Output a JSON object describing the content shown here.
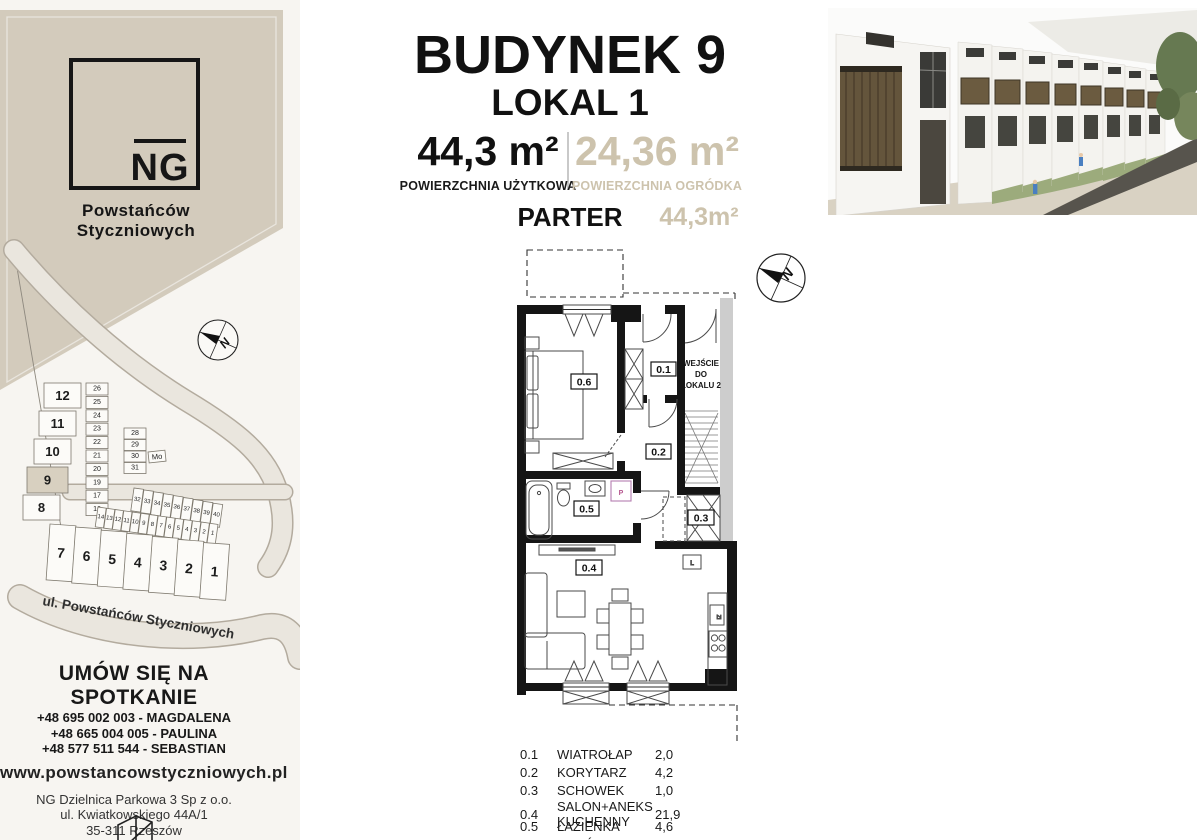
{
  "brand": {
    "logo_text": "NG",
    "name_line1": "Powstańców",
    "name_line2": "Styczniowych"
  },
  "header": {
    "building_title": "BUDYNEK 9",
    "unit_title": "LOKAL 1",
    "usable_area": "44,3 m²",
    "usable_area_label": "POWIERZCHNIA UŻYTKOWA",
    "garden_area": "24,36 m²",
    "garden_area_label": "POWIERZCHNIA OGRÓDKA",
    "floor_label": "PARTER",
    "floor_area": "44,3m²"
  },
  "floorplan": {
    "entrance_note_line1": "WEJŚCIE",
    "entrance_note_line2": "DO",
    "entrance_note_line3": "LOKALU 2",
    "compass_n": "N",
    "washer_label": "P",
    "fridge_label": "L",
    "sink_label": "Zl"
  },
  "legend": {
    "rows": [
      {
        "id": "0.1",
        "name": "WIATROŁAP",
        "area": "2,0"
      },
      {
        "id": "0.2",
        "name": "KORYTARZ",
        "area": "4,2"
      },
      {
        "id": "0.3",
        "name": "SCHOWEK",
        "area": "1,0"
      },
      {
        "id": "0.4",
        "name": "SALON+ANEKS KUCHENNY",
        "area": "21,9"
      },
      {
        "id": "0.5",
        "name": "ŁAZIENKA",
        "area": "4,6"
      },
      {
        "id": "0.6",
        "name": "POKÓJ",
        "area": "10,6"
      }
    ]
  },
  "sitemap": {
    "street_label": "ul. Powstańców Styczniowych",
    "compass_n": "N",
    "buildings_left": [
      {
        "n": "12",
        "x": 44,
        "y": 138
      },
      {
        "n": "11",
        "x": 39,
        "y": 166
      },
      {
        "n": "10",
        "x": 34,
        "y": 194
      },
      {
        "n": "9",
        "x": 27,
        "y": 222,
        "w": 41,
        "h": 26,
        "hl": true
      },
      {
        "n": "8",
        "x": 23,
        "y": 250
      }
    ],
    "garage_col": [
      {
        "n": "26",
        "x": 86,
        "y": 138
      },
      {
        "n": "25",
        "x": 86,
        "y": 151.4
      },
      {
        "n": "24",
        "x": 86,
        "y": 164.8
      },
      {
        "n": "23",
        "x": 86,
        "y": 178.2
      },
      {
        "n": "22",
        "x": 86,
        "y": 191.6
      },
      {
        "n": "21",
        "x": 86,
        "y": 205
      },
      {
        "n": "20",
        "x": 86,
        "y": 218.4
      },
      {
        "n": "19",
        "x": 86,
        "y": 231.8
      },
      {
        "n": "17",
        "x": 86,
        "y": 245.2
      },
      {
        "n": "16",
        "x": 86,
        "y": 258.6
      }
    ],
    "col_right": [
      {
        "n": "28",
        "x": 124,
        "y": 183
      },
      {
        "n": "29",
        "x": 124,
        "y": 194.5
      },
      {
        "n": "30",
        "x": 124,
        "y": 206
      },
      {
        "n": "31",
        "x": 124,
        "y": 217.5
      }
    ],
    "mo_box": [
      {
        "n": "Mo",
        "x": 148,
        "y": 207,
        "w": 17,
        "h": 11,
        "r": -6
      }
    ],
    "diag_row": [
      {
        "n": "32",
        "x": 134,
        "y": 243,
        "r": 8
      },
      {
        "n": "33",
        "x": 143.9,
        "y": 244.9,
        "r": 8
      },
      {
        "n": "34",
        "x": 153.8,
        "y": 246.8,
        "r": 8
      },
      {
        "n": "35",
        "x": 163.7,
        "y": 248.7,
        "r": 8
      },
      {
        "n": "36",
        "x": 173.6,
        "y": 250.6,
        "r": 8
      },
      {
        "n": "37",
        "x": 183.5,
        "y": 252.5,
        "r": 8
      },
      {
        "n": "38",
        "x": 193.4,
        "y": 254.4,
        "r": 8
      },
      {
        "n": "39",
        "x": 203.3,
        "y": 256.3,
        "r": 8
      },
      {
        "n": "40",
        "x": 213.2,
        "y": 258.2,
        "r": 8
      }
    ],
    "small_row": [
      {
        "n": "14",
        "x": 98,
        "y": 262,
        "r": 8
      },
      {
        "n": "13",
        "x": 106.6,
        "y": 263.3,
        "r": 8
      },
      {
        "n": "12",
        "x": 115.2,
        "y": 264.5,
        "r": 8
      },
      {
        "n": "11",
        "x": 123.8,
        "y": 265.8,
        "r": 8
      },
      {
        "n": "10",
        "x": 132.4,
        "y": 267,
        "r": 8
      },
      {
        "n": "9",
        "x": 141,
        "y": 268.3,
        "r": 8
      },
      {
        "n": "8",
        "x": 149.6,
        "y": 269.5,
        "r": 8
      },
      {
        "n": "7",
        "x": 158.2,
        "y": 270.8,
        "r": 8
      },
      {
        "n": "6",
        "x": 166.8,
        "y": 272,
        "r": 8
      },
      {
        "n": "5",
        "x": 175.4,
        "y": 273.3,
        "r": 8
      },
      {
        "n": "4",
        "x": 184,
        "y": 274.5,
        "r": 8
      },
      {
        "n": "3",
        "x": 192.6,
        "y": 275.8,
        "r": 8
      },
      {
        "n": "2",
        "x": 201.2,
        "y": 277,
        "r": 8
      },
      {
        "n": "1",
        "x": 209.8,
        "y": 278.3,
        "r": 8
      }
    ],
    "big_row": [
      {
        "n": "7",
        "x": 50,
        "y": 279,
        "r": 4
      },
      {
        "n": "6",
        "x": 75.6,
        "y": 282.1,
        "r": 4
      },
      {
        "n": "5",
        "x": 101.2,
        "y": 285.2,
        "r": 4
      },
      {
        "n": "4",
        "x": 126.8,
        "y": 288.3,
        "r": 4
      },
      {
        "n": "3",
        "x": 152.4,
        "y": 291.4,
        "r": 4
      },
      {
        "n": "2",
        "x": 178,
        "y": 294.5,
        "r": 4
      },
      {
        "n": "1",
        "x": 203.6,
        "y": 297.6,
        "r": 4
      }
    ]
  },
  "contact": {
    "heading": "UMÓW SIĘ NA SPOTKANIE",
    "phones": [
      "+48 695 002 003 - MAGDALENA",
      "+48 665 004 005 - PAULINA",
      "+48 577 511 544 - SEBASTIAN"
    ],
    "website": "www.powstancowstyczniowych.pl",
    "company": [
      "NG Dzielnica Parkowa 3 Sp z o.o.",
      "ul. Kwiatkowskiego 44A/1",
      "35-311 Rzeszów"
    ]
  },
  "colors": {
    "accent_beige": "#d3cbbc",
    "accent_text": "#cdc3ad",
    "wall_black": "#151515",
    "sidebar_bg": "#f7f5f1"
  }
}
